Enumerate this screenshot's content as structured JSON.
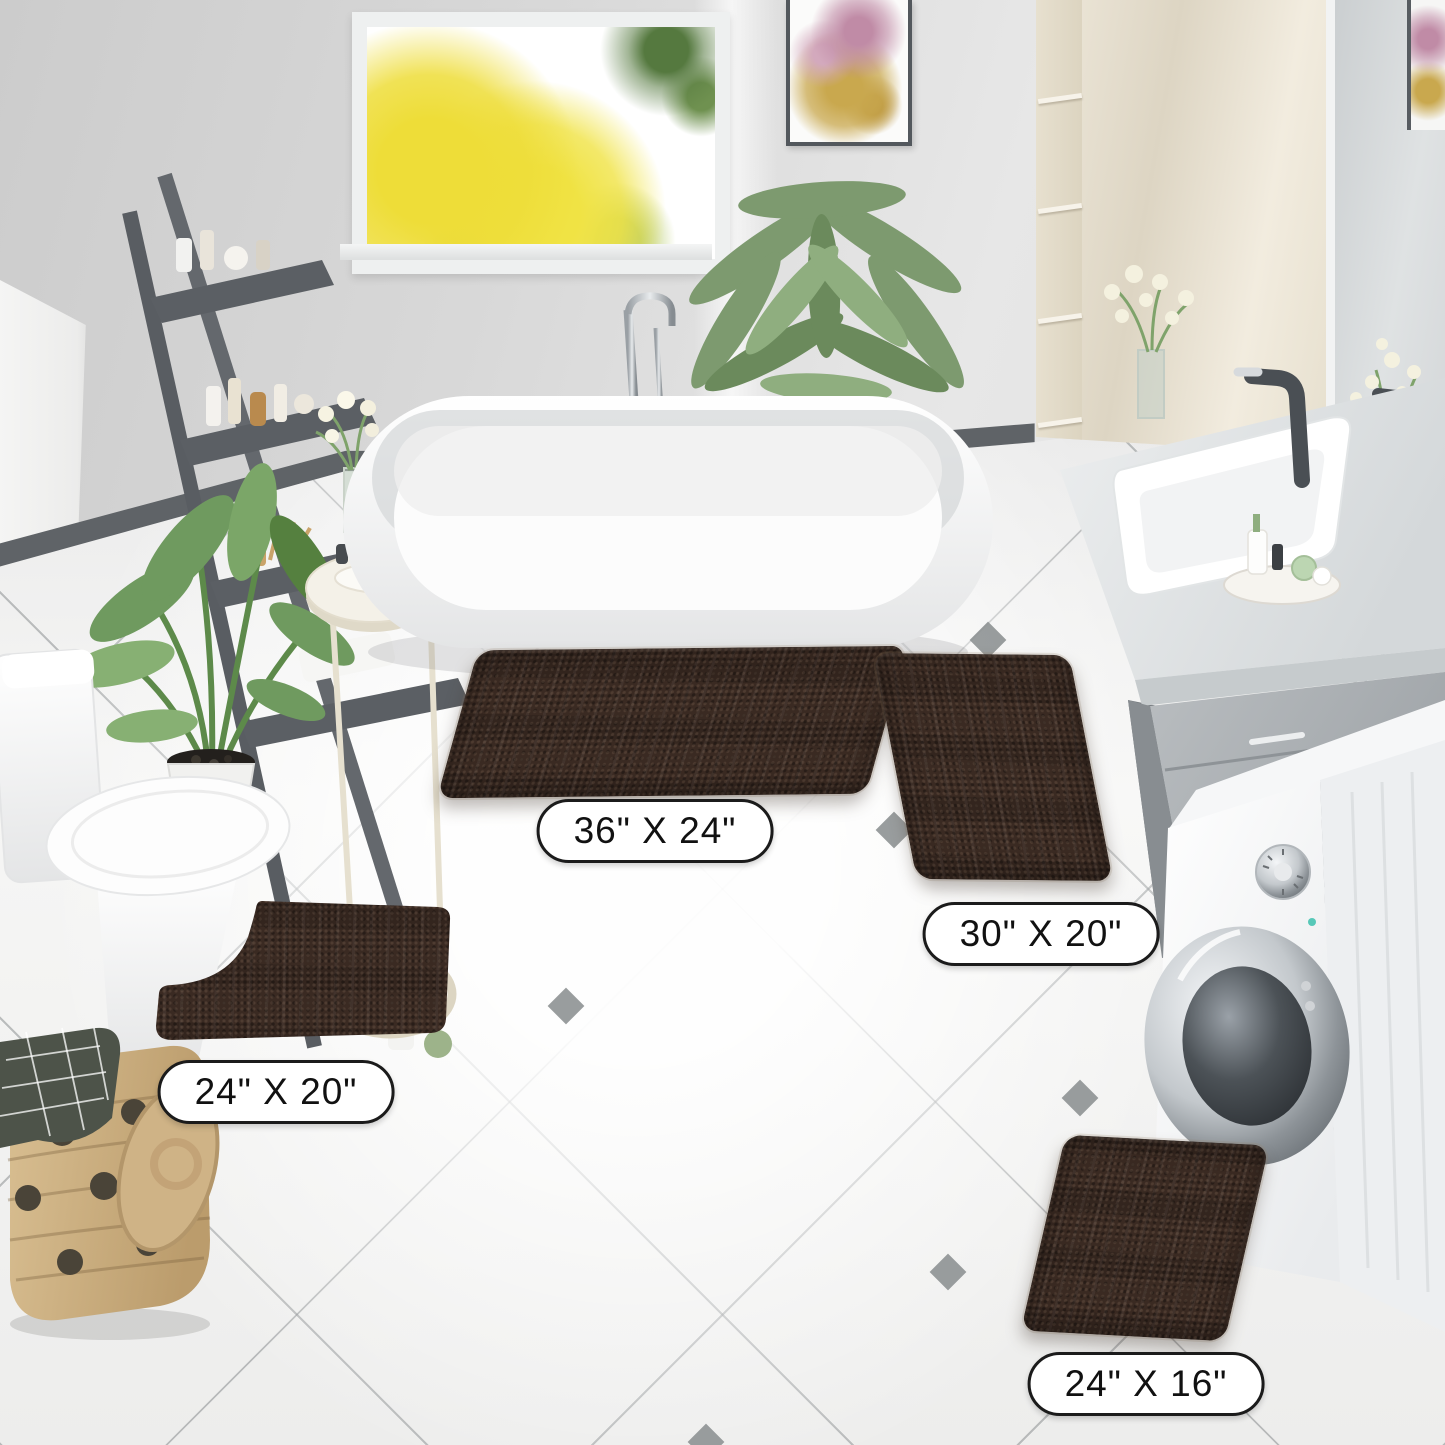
{
  "scene": {
    "kind": "bathroom product photo",
    "product": "chenille bath rug set, brown",
    "rug_color": "#3a2a22",
    "label_border_color": "#1b1b1b",
    "label_background": "#ffffff"
  },
  "size_labels": [
    {
      "id": "rug-36x24",
      "text": "36\" X 24\""
    },
    {
      "id": "rug-30x20",
      "text": "30\" X 20\""
    },
    {
      "id": "rug-24x20",
      "text": "24\" X 20\""
    },
    {
      "id": "rug-24x16",
      "text": "24\" X 16\""
    }
  ]
}
